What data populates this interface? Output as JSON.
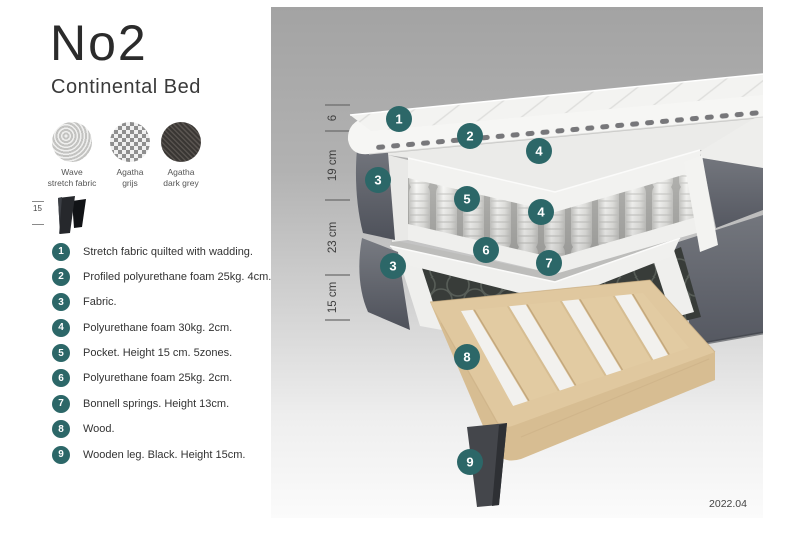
{
  "header": {
    "title": "No2",
    "subtitle": "Continental Bed"
  },
  "swatches": [
    {
      "name": "wave-stretch-fabric",
      "label": "Wave\nstretch fabric"
    },
    {
      "name": "agatha-grijs",
      "label": "Agatha\ngrijs"
    },
    {
      "name": "agatha-dark-grey",
      "label": "Agatha\ndark grey"
    }
  ],
  "leg_icon": {
    "height_label": "15"
  },
  "legend": {
    "items": [
      {
        "num": "1",
        "text": "Stretch fabric quilted with wadding."
      },
      {
        "num": "2",
        "text": "Profiled polyurethane foam 25kg. 4cm."
      },
      {
        "num": "3",
        "text": "Fabric."
      },
      {
        "num": "4",
        "text": "Polyurethane foam 30kg. 2cm."
      },
      {
        "num": "5",
        "text": "Pocket. Height 15 cm. 5zones."
      },
      {
        "num": "6",
        "text": "Polyurethane foam 25kg. 2cm."
      },
      {
        "num": "7",
        "text": "Bonnell springs. Height 13cm."
      },
      {
        "num": "8",
        "text": "Wood."
      },
      {
        "num": "9",
        "text": "Wooden leg. Black. Height 15cm."
      }
    ]
  },
  "diagram": {
    "ruler": {
      "segments": [
        {
          "label": "6"
        },
        {
          "label": "19 cm"
        },
        {
          "label": "23 cm"
        },
        {
          "label": "15 cm"
        }
      ]
    },
    "badges": [
      {
        "num": "1"
      },
      {
        "num": "2"
      },
      {
        "num": "4"
      },
      {
        "num": "3"
      },
      {
        "num": "5"
      },
      {
        "num": "4"
      },
      {
        "num": "6"
      },
      {
        "num": "7"
      },
      {
        "num": "3"
      },
      {
        "num": "8"
      },
      {
        "num": "9"
      }
    ],
    "caption": "2022.04",
    "colors": {
      "badge_teal": "#2c6768",
      "fabric_grey": "#62656c",
      "wood": "#e0c89f",
      "panel_grey_top": "#a4a4a4",
      "spring_white": "#f4f4f2",
      "bonnell_dark": "#3a3e3b"
    }
  }
}
